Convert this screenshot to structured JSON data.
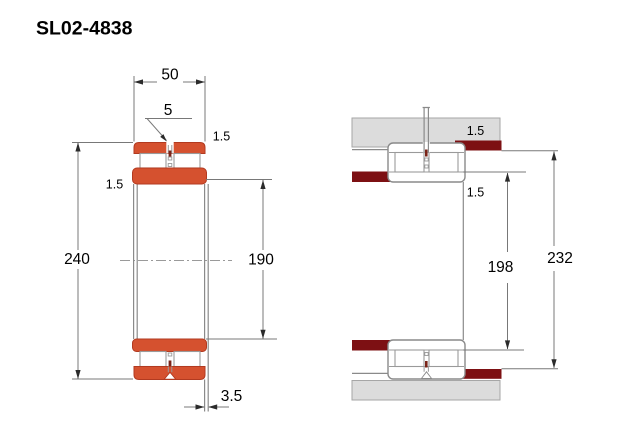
{
  "title": "SL02-4838",
  "colors": {
    "ring_fill": "#D5512F",
    "ring_stroke": "#B23A20",
    "shoulder_fill": "#7D1013",
    "housing_fill": "#DCDCDC",
    "housing_stroke": "#A6A6A6",
    "outline": "#8A8A8A",
    "dim_line": "#787878",
    "arrow": "#2B2B2B"
  },
  "left_view": {
    "width": "50",
    "lube_hole": "5",
    "outer_chamfer": "1.5",
    "inner_chamfer": "1.5",
    "outer_diameter": "240",
    "bore_diameter": "190",
    "face_offset": "3.5"
  },
  "right_view": {
    "housing_fillet": "1.5",
    "shaft_fillet": "1.5",
    "shaft_shoulder_diameter": "198",
    "housing_shoulder_diameter": "232"
  }
}
